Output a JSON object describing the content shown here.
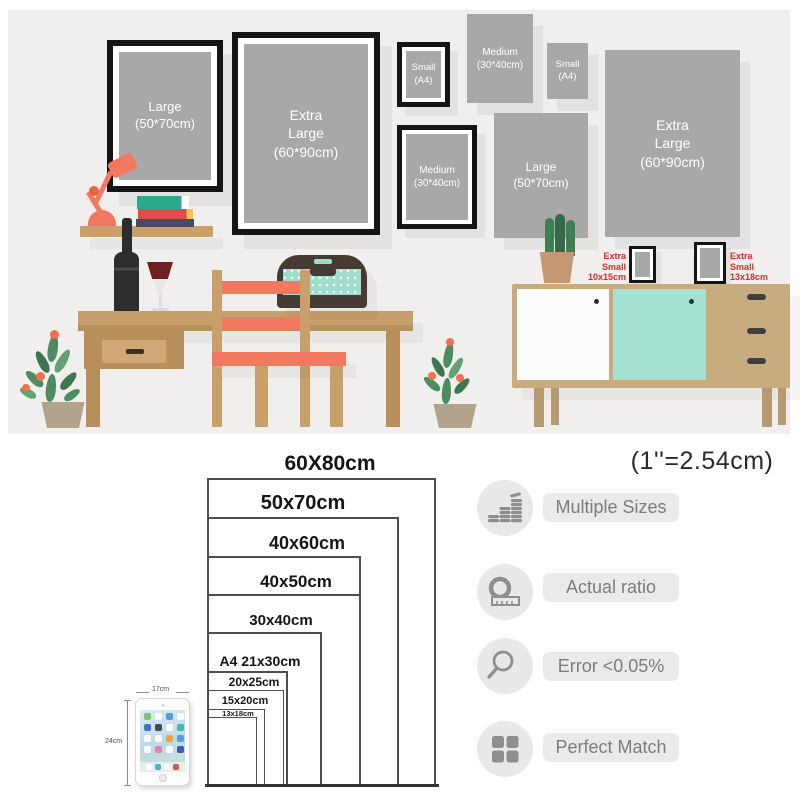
{
  "palette": {
    "scene_background": "#f0efed",
    "poster_gray": "#a8a8a8",
    "frame_black": "#141414",
    "wood": "#c9a06c",
    "accent_coral": "#f2795f",
    "mint": "#a5e1d1",
    "xs_label_red": "#e02a2a",
    "icon_gray": "#8f8f8f"
  },
  "scene": {
    "frames": [
      {
        "name": "large-framed",
        "lines": [
          "Large",
          "(50*70cm)",
          ""
        ]
      },
      {
        "name": "extra-large-framed",
        "lines": [
          "Extra",
          "Large",
          "(60*90cm)"
        ]
      },
      {
        "name": "small-framed",
        "lines": [
          "Small",
          "(A4)",
          ""
        ]
      },
      {
        "name": "medium-poster",
        "lines": [
          "Medium",
          "(30*40cm)",
          ""
        ]
      },
      {
        "name": "small-poster",
        "lines": [
          "Small",
          "(A4)",
          ""
        ]
      },
      {
        "name": "medium-framed",
        "lines": [
          "Medium",
          "(30*40cm)",
          ""
        ]
      },
      {
        "name": "large-poster",
        "lines": [
          "Large",
          "(50*70cm)",
          ""
        ]
      },
      {
        "name": "extra-large-poster",
        "lines": [
          "Extra",
          "Large",
          "(60*90cm)"
        ]
      }
    ],
    "xs_labels": [
      {
        "lines": [
          "Extra",
          "Small",
          "10x15cm"
        ]
      },
      {
        "lines": [
          "Extra",
          "Small",
          "13x18cm"
        ]
      }
    ]
  },
  "size_chart": {
    "note": "(1''=2.54cm)",
    "sizes": [
      {
        "label": "60X80cm",
        "w_cm": 60,
        "h_cm": 80
      },
      {
        "label": "50x70cm",
        "w_cm": 50,
        "h_cm": 70
      },
      {
        "label": "40x60cm",
        "w_cm": 40,
        "h_cm": 60
      },
      {
        "label": "40x50cm",
        "w_cm": 40,
        "h_cm": 50
      },
      {
        "label": "30x40cm",
        "w_cm": 30,
        "h_cm": 40
      },
      {
        "label": "A4 21x30cm",
        "w_cm": 21,
        "h_cm": 30
      },
      {
        "label": "20x25cm",
        "w_cm": 20,
        "h_cm": 25
      },
      {
        "label": "15x20cm",
        "w_cm": 15,
        "h_cm": 20
      },
      {
        "label": "13x18cm",
        "w_cm": 13,
        "h_cm": 18
      }
    ],
    "tablet": {
      "width_label": "17cm",
      "height_label": "24cm"
    }
  },
  "features": [
    {
      "icon": "coins-icon",
      "label": "Multiple Sizes"
    },
    {
      "icon": "tape-measure-icon",
      "label": "Actual ratio"
    },
    {
      "icon": "magnifier-icon",
      "label": "Error <0.05%"
    },
    {
      "icon": "grid-icon",
      "label": "Perfect Match"
    }
  ]
}
